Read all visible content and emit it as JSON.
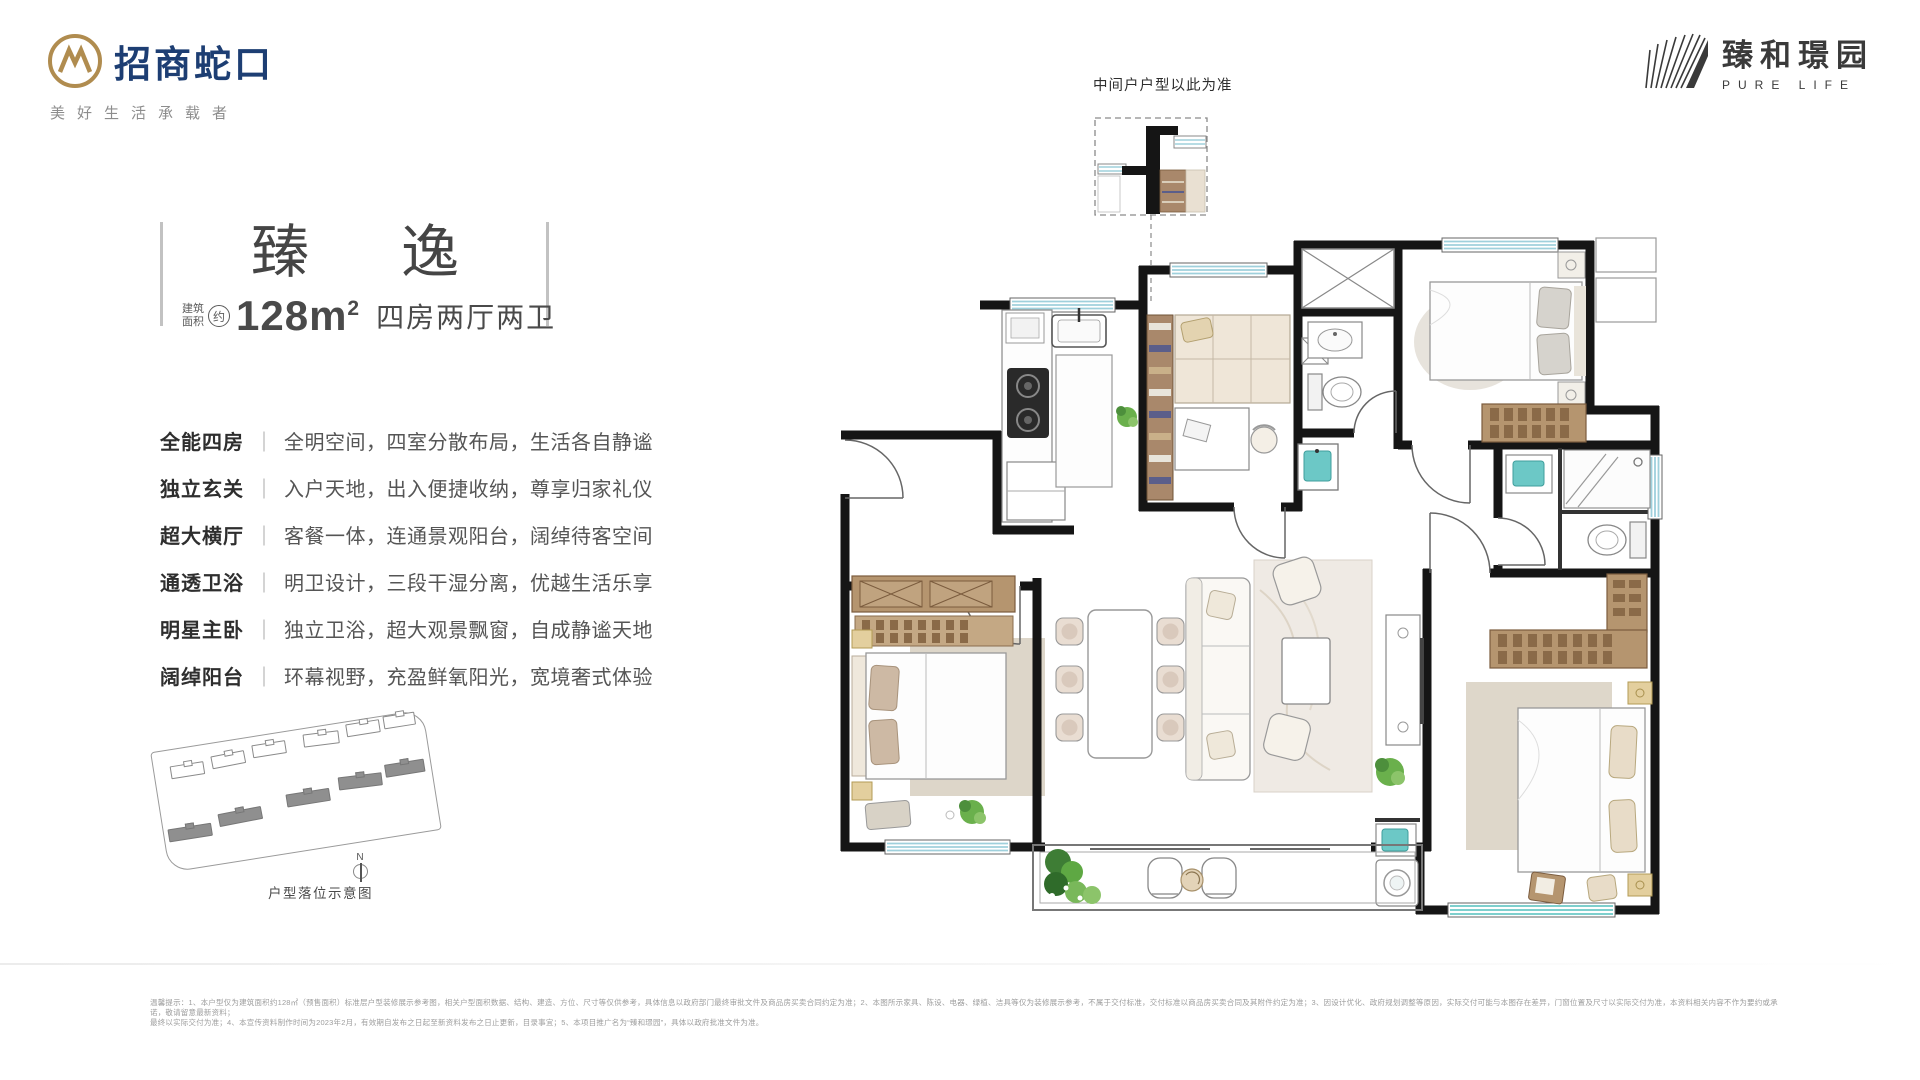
{
  "header": {
    "brand_name": "招商蛇口",
    "brand_tagline": "美好生活承载者",
    "project_name": "臻和璟园",
    "project_subtitle": "PURE LIFE"
  },
  "title": {
    "char1": "臻",
    "char2": "逸",
    "area_prefix_line1": "建筑",
    "area_prefix_line2": "面积",
    "area_circle": "约",
    "area_value": "128m",
    "area_sup": "2",
    "layout_text": "四房两厅两卫"
  },
  "features": [
    {
      "label": "全能四房",
      "desc": "全明空间，四室分散布局，生活各自静谧"
    },
    {
      "label": "独立玄关",
      "desc": "入户天地，出入便捷收纳，尊享归家礼仪"
    },
    {
      "label": "超大横厅",
      "desc": "客餐一体，连通景观阳台，阔绰待客空间"
    },
    {
      "label": "通透卫浴",
      "desc": "明卫设计，三段干湿分离，优越生活乐享"
    },
    {
      "label": "明星主卧",
      "desc": "独立卫浴，超大观景飘窗，自成静谧天地"
    },
    {
      "label": "阔绰阳台",
      "desc": "环幕视野，充盈鲜氧阳光，宽境奢式体验"
    }
  ],
  "separator": "｜",
  "plan": {
    "note": "中间户户型以此为准"
  },
  "site_map": {
    "caption": "户型落位示意图",
    "compass": "N"
  },
  "disclaimer": {
    "line1": "温馨提示：1、本户型仅为建筑面积约128㎡（预售面积）标准层户型装修展示参考图，相关户型面积数据、结构、建造、方位、尺寸等仅供参考，具体信息以政府部门最终审批文件及商品房买卖合同约定为准；2、本图所示家具、陈设、电器、绿植、洁具等仅为装修展示参考，不属于交付标准，交付标准以商品房买卖合同及其附件约定为准；3、因设计优化、政府规划调整等原因，实际交付可能与本图存在差异，门窗位置及尺寸以实际交付为准，本资料相关内容不作为要约或承诺，敬请留意最新资料；",
    "line2": "最终以实际交付为准；4、本宣传资料制作时间为2023年2月，有效期自发布之日起至新资料发布之日止更新，目录事宜；5、本项目推广名为“臻和璟园”，具体以政府批准文件为准。"
  },
  "colors": {
    "wall": "#151515",
    "window_blue": "#9fd0dc",
    "window_teal": "#6cc8c6",
    "wood": "#b5956f",
    "brand_navy": "#1d3e73",
    "brand_gold": "#b08c4f"
  }
}
